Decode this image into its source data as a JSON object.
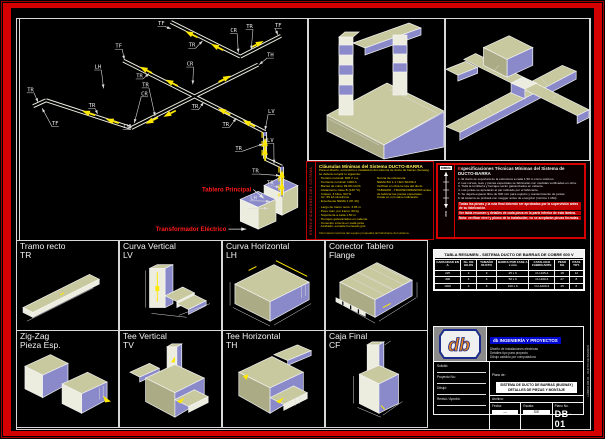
{
  "sheet": {
    "number": "DB-01",
    "border_color": "#D40000"
  },
  "main_view": {
    "annotation_color": "#FF1A1A",
    "segments": [
      [
        152,
        3,
        222,
        38,
        0
      ],
      [
        222,
        38,
        263,
        17,
        0
      ],
      [
        104,
        42,
        247,
        114,
        0
      ],
      [
        240,
        46,
        112,
        110,
        0
      ],
      [
        112,
        110,
        26,
        82,
        0
      ],
      [
        26,
        82,
        13,
        88,
        0
      ],
      [
        247,
        114,
        247,
        141,
        1
      ],
      [
        247,
        141,
        264,
        149,
        0
      ],
      [
        264,
        149,
        264,
        179,
        1
      ]
    ],
    "arrows": [
      [
        170,
        14,
        207
      ],
      [
        196,
        27,
        207
      ],
      [
        242,
        24,
        333
      ],
      [
        124,
        50,
        207
      ],
      [
        150,
        63,
        207
      ],
      [
        203,
        92,
        207
      ],
      [
        228,
        104,
        207
      ],
      [
        209,
        59,
        333
      ],
      [
        148,
        97,
        153
      ],
      [
        130,
        104,
        153
      ],
      [
        66,
        94,
        198
      ],
      [
        90,
        102,
        198
      ],
      [
        247,
        124,
        270
      ],
      [
        247,
        133,
        270
      ],
      [
        264,
        156,
        270
      ],
      [
        264,
        168,
        270
      ]
    ],
    "labels": [
      [
        "TF",
        139,
        6,
        152,
        10
      ],
      [
        "TR",
        170,
        28,
        184,
        22
      ],
      [
        "CR",
        212,
        13,
        220,
        34
      ],
      [
        "TR",
        228,
        9,
        233,
        31
      ],
      [
        "TF",
        257,
        8,
        260,
        16
      ],
      [
        "TH",
        249,
        38,
        241,
        46
      ],
      [
        "TF",
        96,
        29,
        105,
        41
      ],
      [
        "TR",
        117,
        59,
        130,
        55
      ],
      [
        "CR",
        168,
        47,
        174,
        66
      ],
      [
        "TR",
        123,
        68,
        136,
        98
      ],
      [
        "CR",
        122,
        77,
        115,
        105
      ],
      [
        "LH",
        75,
        50,
        84,
        70
      ],
      [
        "TR",
        7,
        73,
        18,
        84
      ],
      [
        "TR",
        69,
        89,
        78,
        96
      ],
      [
        "TF",
        32,
        107,
        22,
        90
      ],
      [
        "LV",
        104,
        110,
        111,
        106
      ],
      [
        "TR",
        173,
        90,
        185,
        84
      ],
      [
        "TR",
        204,
        108,
        218,
        100
      ],
      [
        "LV",
        250,
        95,
        247,
        112
      ],
      [
        "TR",
        217,
        132,
        245,
        126
      ],
      [
        "LV",
        249,
        124,
        256,
        146
      ],
      [
        "TR",
        234,
        155,
        262,
        158
      ],
      [
        "TR",
        249,
        167,
        262,
        170
      ],
      [
        "LH",
        232,
        182,
        252,
        184
      ],
      [
        "F",
        230,
        190,
        250,
        191
      ]
    ],
    "annotations": [
      [
        "Tablero Principal",
        233,
        174,
        246,
        181
      ],
      [
        "Transformador Eléctrico",
        208,
        214,
        228,
        212
      ]
    ]
  },
  "spec_yellow": {
    "side_label": "ESPECIFICACIONES DEL SISTEMA",
    "title": "Cláusulas Mínimas del Sistema DUCTO-BARRA",
    "subtitle": "Para el diseño, suministro e instalación del sistema de ducto de barras (busway) se deberá cumplir lo siguiente:",
    "col_left": [
      "· Tensión nominal: 600 V c.a.",
      "· Corriente nominal: 1000 A",
      "· Barras de cobre 99.9% IACS",
      "· Aislamiento clase B (130 °C)",
      "· 3 fases, 4 hilos, 60 Hz",
      "· Icc: 65 kA simétricos",
      "· Envolvente NEMA 1 (IP-40)"
    ],
    "col_right": [
      "Norma de referencia:",
      "NEMA BU 1.1 / IEC 60439-2",
      "Verificar en obra la ruta del ducto",
      "TABLERO - TRANSFORMADOR antes",
      "de fabricar las piezas especiales.",
      "Cotas en mm salvo indicación."
    ],
    "extra": [
      "· Largo de tramo recto: 3.05 m",
      "· Peso máx. por tramo: 60 kg",
      "· Soportería a cada 1.50 m",
      "· Herrajes galvanizados en caliente",
      "· Conexión a tierra en cada junta",
      "· Acabado: esmalte horneado gris"
    ],
    "footer": "Información técnica del equipo propiedad del fabricante del sistema"
  },
  "spec_red": {
    "corner": "DIMEN.",
    "ruler_unit": "mm",
    "title": "Especificaciones Técnicas Mínimas del Sistema de DUCTO-BARRA",
    "lines": [
      "1. El ducto se soportará de la estructura a cada 1.50 m como máximo.",
      "2. Las curvas, tees y piezas especiales se fabricarán con medidas verificadas en obra.",
      "3. Toda la tornillería y herrajes serán galvanizados en caliente.",
      "4. Las juntas se apretarán al par indicado por el fabricante.",
      "5. Se dejará espacio libre de 600 mm para registro y mantenimiento de juntas.",
      "6. El sistema se probará con megger antes de energizar (mínimo 1 MΩ)."
    ],
    "notes": [
      "Todas las piezas y la ruta final deberán ser aprobadas por la supervisión antes de su fabricación.",
      "Ver tabla resumen y detalles de cada pieza en la parte inferior de esta lámina.",
      "Nota: verificar nivel y plomo de la instalación; no se aceptarán piezas forzadas."
    ]
  },
  "cells": [
    {
      "name": "Tramo recto",
      "code": "TR"
    },
    {
      "name": "Curva Vertical",
      "code": "LV"
    },
    {
      "name": "Curva Horizontal",
      "code": "LH"
    },
    {
      "name": "Conector Tablero",
      "code": "Flange"
    },
    {
      "name": "Zig-Zag",
      "code": "Pieza Esp."
    },
    {
      "name": "Tee Vertical",
      "code": "TV"
    },
    {
      "name": "Tee Horizontal",
      "code": "TH"
    },
    {
      "name": "Caja Final",
      "code": "CF"
    }
  ],
  "table": {
    "title": "TABLA RESUMEN - SISTEMA DUCTO DE BARRAS DE COBRE 600 V",
    "headers": [
      "CAPACIDAD EN A",
      "No. DE HILOS",
      "TAMAÑO DUCTO",
      "BARRA POR FASE A x mm",
      "CATALOGO FABRICANTE",
      "PESO KG",
      "PZAS TOT."
    ],
    "rows": [
      [
        "225",
        "4",
        "3",
        "25 x 6",
        "CU-225-4",
        "18",
        "12"
      ],
      [
        "400",
        "4",
        "4",
        "50 x 6",
        "CU-400-4",
        "27",
        "8"
      ],
      [
        "1000",
        "4",
        "6",
        "100 x 6",
        "CU-1000-4",
        "45",
        "6"
      ]
    ]
  },
  "titleblock": {
    "logo_text": "db",
    "company": "db INGENIERÍA Y PROYECTOS",
    "company_lines": [
      "Diseño de instalaciones eléctricas",
      "Detalles tipo para proyecto",
      "Dibujo asistido por computadora"
    ],
    "fields": [
      {
        "label": "Solicitó:"
      },
      {
        "label": "Proyecto No.:"
      },
      {
        "label": "Dibujó:"
      },
      {
        "label": "Revisó / Aprobó:"
      }
    ],
    "plano_label": "Plano de:",
    "plano_line1": "SISTEMA DE DUCTO DE BARRAS (BUSWAY)",
    "plano_line2": "DETALLES DE PIEZAS Y MONTAJE",
    "file_label": "Archivo:",
    "bottom": [
      {
        "label": "Fecha:",
        "value": "—"
      },
      {
        "label": "Escala:",
        "value": "S/E"
      },
      {
        "label": "Plano No.",
        "value": "DB-01"
      }
    ],
    "margin_text": "LÁMINA DB-01 · DUCTO DE BARRAS"
  }
}
